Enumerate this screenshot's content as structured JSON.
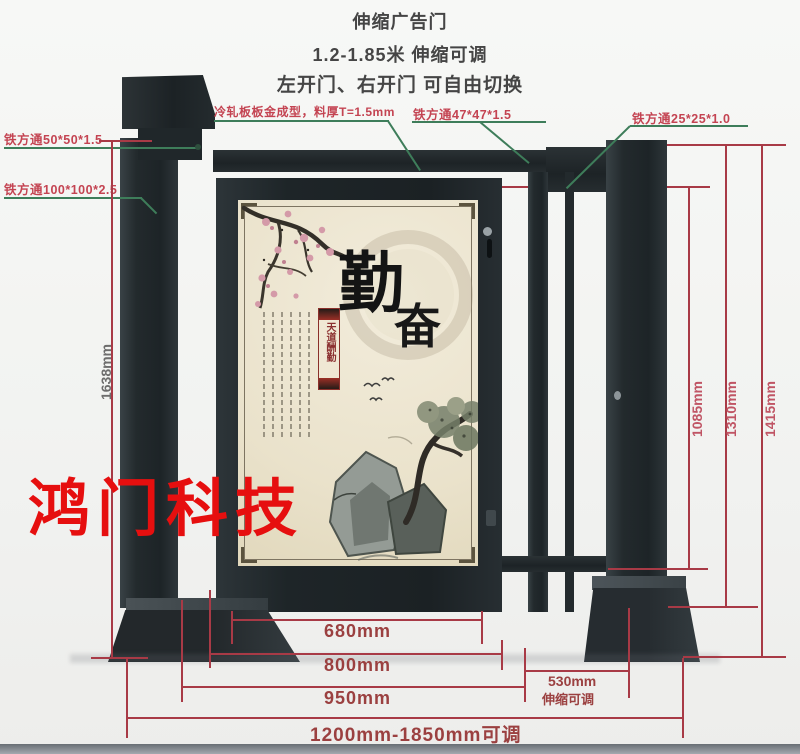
{
  "header": {
    "product_name": "伸缩广告门",
    "size_range": "1.2-1.85米 伸缩可调",
    "switch_note": "左开门、右开门 可自由切换"
  },
  "callouts": {
    "square_tube_50": "铁方通50*50*1.5",
    "square_tube_100": "铁方通100*100*2.5",
    "cold_rolled_panel": "冷轧板板金成型，料厚T=1.5mm",
    "square_tube_47": "铁方通47*47*1.5",
    "square_tube_25": "铁方通25*25*1.0"
  },
  "dimensions": {
    "post_height_left": "1638mm",
    "opening_height": "1085mm",
    "frame_height": "1310mm",
    "total_height": "1415mm",
    "poster_width": "680mm",
    "door_width": "800mm",
    "door_with_post_width": "950mm",
    "retract_width": "530mm",
    "retract_note": "伸缩可调",
    "overall_width_range": "1200mm-1850mm可调"
  },
  "poster": {
    "main_char": "勤",
    "sub_char": "奋",
    "seal_text": "天道酬勤"
  },
  "watermark": {
    "text": "鸿门科技"
  },
  "colors": {
    "dimension_line": "#a83a46",
    "leader_line": "#3e7d5a",
    "callout_text": "#c44452",
    "watermark_red": "#e60f0f",
    "metal_dark": "#22282b",
    "poster_bg": "#ebe3cd"
  }
}
